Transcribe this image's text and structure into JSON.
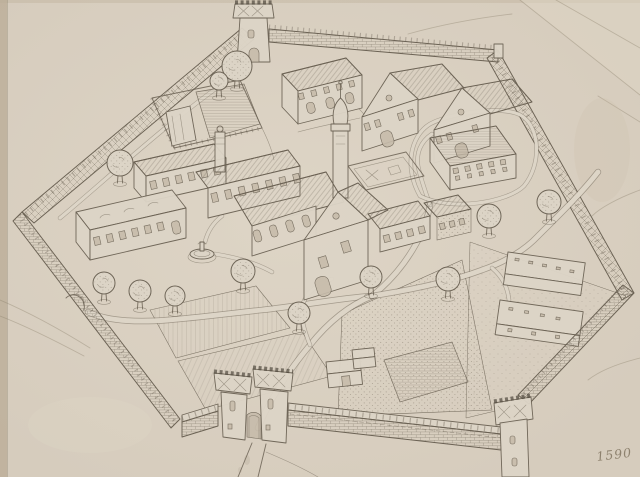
{
  "artwork": {
    "inscription": "1590",
    "description": "Hand-drawn pencil bird's-eye view of a walled compound: a hexagonal crenellated perimeter wall with a square watchtower, a twin-towered gatehouse and a round corner tower; inside stand a church with an onion-domed spire and chimneyed west range, long buildings with rows of windows, steep-gabled houses, a cloister court, a fountain, sheds and flat-roofed outbuildings among hatched field plots, stippled orchards, winding paths and round trees."
  },
  "colors": {
    "paper": "#d6ccbd",
    "paper_light": "#ddd5c7",
    "paper_shade": "#c7bcab",
    "paper_edge": "#b9ab96",
    "ink": "#6b6254",
    "ink_dark": "#50483d",
    "ink_light": "#8a7e6a"
  },
  "scene": {
    "trees": [
      {
        "x": 237,
        "y": 66,
        "r": 15
      },
      {
        "x": 219,
        "y": 81,
        "r": 9
      },
      {
        "x": 120,
        "y": 163,
        "r": 13
      },
      {
        "x": 104,
        "y": 283,
        "r": 11
      },
      {
        "x": 140,
        "y": 291,
        "r": 11
      },
      {
        "x": 175,
        "y": 296,
        "r": 10
      },
      {
        "x": 243,
        "y": 271,
        "r": 12
      },
      {
        "x": 299,
        "y": 313,
        "r": 11
      },
      {
        "x": 371,
        "y": 277,
        "r": 11
      },
      {
        "x": 448,
        "y": 279,
        "r": 12
      },
      {
        "x": 489,
        "y": 216,
        "r": 12
      },
      {
        "x": 549,
        "y": 202,
        "r": 12
      }
    ]
  }
}
